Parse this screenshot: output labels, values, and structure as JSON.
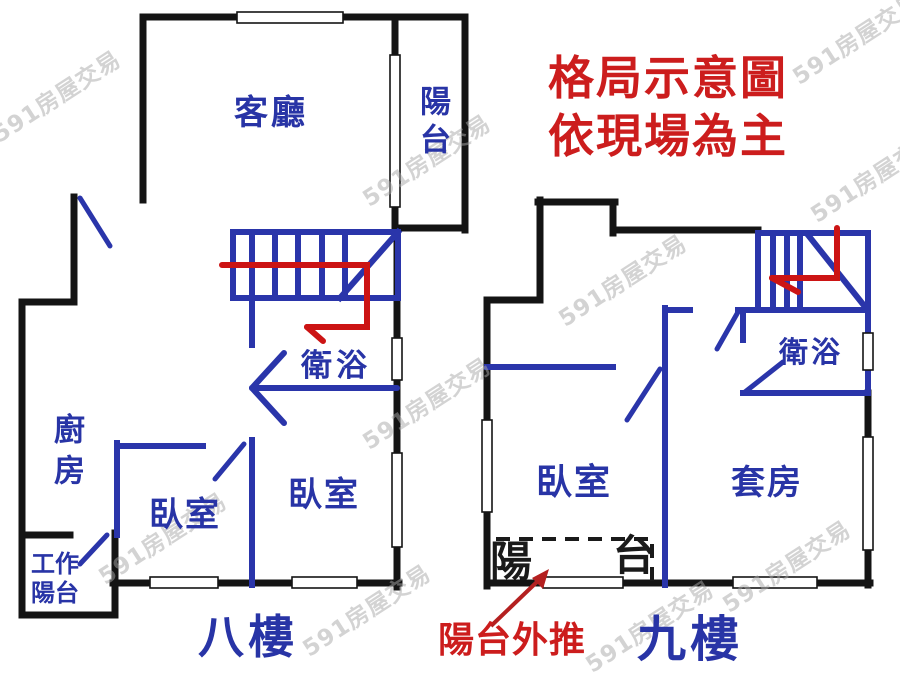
{
  "title": {
    "line1": "格局示意圖",
    "line2": "依現場為主"
  },
  "watermark_text": "591房屋交易",
  "colors": {
    "wall_black": "#141414",
    "line_blue": "#2a35aa",
    "label_blue": "#2834a6",
    "accent_red": "#cc1d1d",
    "watermark_gray": "#a8a8a8"
  },
  "floor8": {
    "floor_label": "八樓",
    "living_room": "客廳",
    "balcony": "陽台",
    "bathroom": "衛浴",
    "kitchen": "廚房",
    "bedroom_left": "臥室",
    "bedroom_right": "臥室",
    "work_balcony_line1": "工作",
    "work_balcony_line2": "陽台"
  },
  "floor9": {
    "floor_label": "九樓",
    "bathroom": "衛浴",
    "bedroom": "臥室",
    "suite": "套房",
    "old_balcony_char_left": "陽",
    "old_balcony_char_right": "台",
    "annotation_balcony_pushed_out": "陽台外推"
  }
}
